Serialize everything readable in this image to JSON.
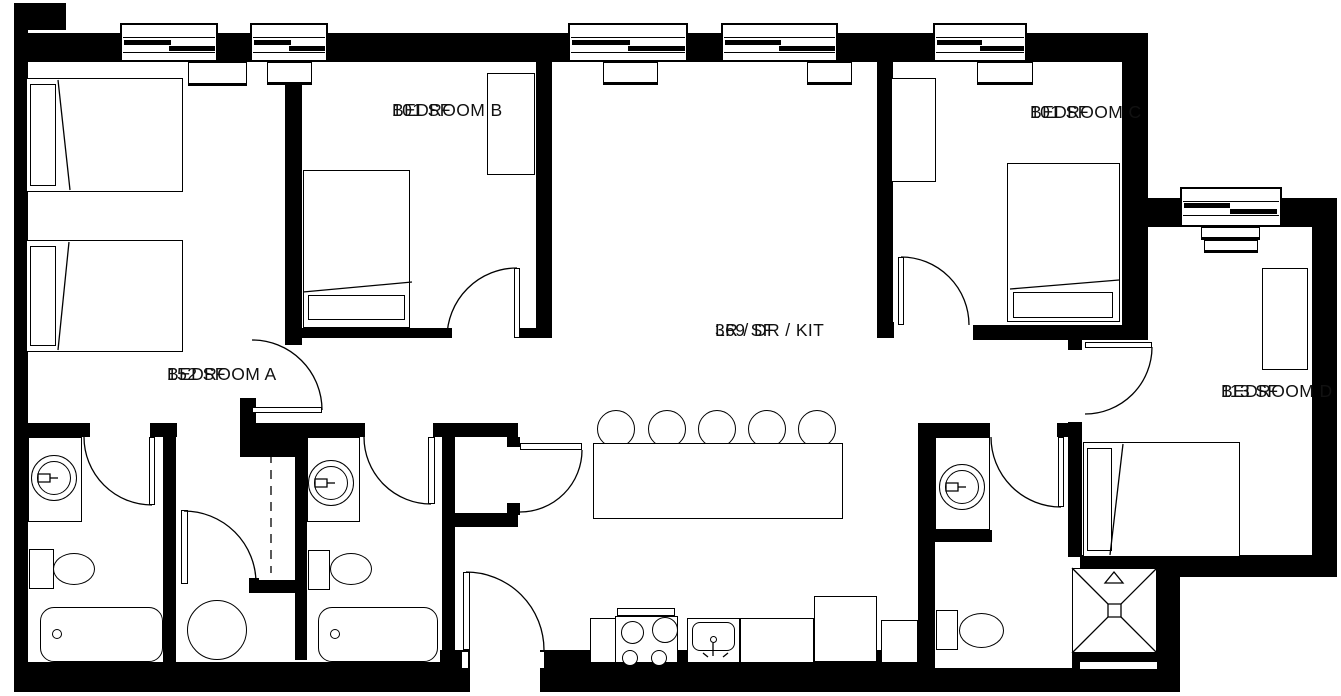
{
  "plan": {
    "title": "4-bedroom unit floor plan",
    "w": 1341,
    "h": 696,
    "ink": "#000000",
    "paper": "#ffffff",
    "rooms": [
      {
        "id": "bedroom-a",
        "name": "BEDROOM A",
        "area": "152 SF",
        "x": 167,
        "y": 362
      },
      {
        "id": "bedroom-b",
        "name": "BEDROOM B",
        "area": "101 SF",
        "x": 392,
        "y": 98
      },
      {
        "id": "bedroom-c",
        "name": "BEDROOM C",
        "area": "101 SF",
        "x": 1030,
        "y": 100
      },
      {
        "id": "living-dining-kitchen",
        "name": "LR / DR / KIT",
        "area": "369 SF",
        "x": 715,
        "y": 318
      },
      {
        "id": "bedroom-d",
        "name": "BEDROOM D",
        "area": "113 SF",
        "x": 1221,
        "y": 379
      }
    ],
    "walls": [
      [
        14,
        3,
        52,
        27
      ],
      [
        14,
        29,
        14,
        663
      ],
      [
        25,
        33,
        1115,
        29
      ],
      [
        285,
        62,
        17,
        283
      ],
      [
        536,
        62,
        16,
        276
      ],
      [
        877,
        62,
        16,
        276
      ],
      [
        1122,
        33,
        26,
        292
      ],
      [
        1148,
        198,
        32,
        29
      ],
      [
        1282,
        198,
        55,
        29
      ],
      [
        1312,
        227,
        25,
        350
      ],
      [
        302,
        328,
        150,
        10
      ],
      [
        517,
        328,
        20,
        10
      ],
      [
        877,
        322,
        17,
        16
      ],
      [
        973,
        325,
        175,
        15
      ],
      [
        1068,
        337,
        14,
        13
      ],
      [
        1068,
        422,
        14,
        135
      ],
      [
        1080,
        555,
        257,
        22
      ],
      [
        1157,
        577,
        23,
        113
      ],
      [
        920,
        668,
        260,
        24
      ],
      [
        1072,
        653,
        85,
        15
      ],
      [
        14,
        662,
        446,
        30
      ],
      [
        440,
        650,
        30,
        42
      ],
      [
        540,
        650,
        395,
        42
      ],
      [
        918,
        423,
        17,
        267
      ],
      [
        918,
        423,
        72,
        14
      ],
      [
        1057,
        423,
        11,
        14
      ],
      [
        933,
        530,
        59,
        12
      ],
      [
        14,
        423,
        76,
        14
      ],
      [
        150,
        423,
        27,
        14
      ],
      [
        163,
        437,
        13,
        230
      ],
      [
        240,
        398,
        16,
        27
      ],
      [
        240,
        423,
        57,
        34
      ],
      [
        249,
        578,
        10,
        15
      ],
      [
        258,
        580,
        40,
        13
      ],
      [
        295,
        423,
        12,
        237
      ],
      [
        300,
        423,
        65,
        14
      ],
      [
        433,
        423,
        85,
        14
      ],
      [
        442,
        437,
        13,
        213
      ],
      [
        452,
        513,
        66,
        14
      ],
      [
        507,
        437,
        13,
        10
      ],
      [
        507,
        503,
        13,
        12
      ]
    ],
    "notches": [
      [
        462,
        652,
        6,
        16
      ],
      [
        538,
        652,
        6,
        16
      ],
      [
        1080,
        662,
        77,
        7
      ]
    ],
    "windows": [
      {
        "frame": [
          120,
          23,
          98,
          39
        ],
        "bars": [
          [
            124,
            40,
            47,
            5
          ],
          [
            169,
            46,
            46,
            5
          ]
        ],
        "lines": [
          [
            123,
            37,
            92,
            1
          ],
          [
            123,
            52,
            92,
            1
          ]
        ]
      },
      {
        "frame": [
          250,
          23,
          78,
          39
        ],
        "bars": [
          [
            254,
            40,
            37,
            5
          ],
          [
            289,
            46,
            36,
            5
          ]
        ],
        "lines": [
          [
            253,
            37,
            72,
            1
          ],
          [
            253,
            52,
            72,
            1
          ]
        ]
      },
      {
        "frame": [
          568,
          23,
          120,
          39
        ],
        "bars": [
          [
            572,
            40,
            58,
            5
          ],
          [
            628,
            46,
            57,
            5
          ]
        ],
        "lines": [
          [
            571,
            37,
            114,
            1
          ],
          [
            571,
            52,
            114,
            1
          ]
        ]
      },
      {
        "frame": [
          721,
          23,
          117,
          39
        ],
        "bars": [
          [
            725,
            40,
            56,
            5
          ],
          [
            779,
            46,
            56,
            5
          ]
        ],
        "lines": [
          [
            724,
            37,
            111,
            1
          ],
          [
            724,
            52,
            111,
            1
          ]
        ]
      },
      {
        "frame": [
          933,
          23,
          94,
          39
        ],
        "bars": [
          [
            937,
            40,
            45,
            5
          ],
          [
            980,
            46,
            44,
            5
          ]
        ],
        "lines": [
          [
            936,
            37,
            88,
            1
          ],
          [
            936,
            52,
            88,
            1
          ]
        ]
      },
      {
        "frame": [
          1180,
          187,
          102,
          40
        ],
        "bars": [
          [
            1184,
            203,
            46,
            5
          ],
          [
            1230,
            209,
            47,
            5
          ]
        ],
        "lines": [
          [
            1183,
            201,
            96,
            1
          ],
          [
            1183,
            215,
            96,
            1
          ]
        ]
      }
    ],
    "sills": [
      [
        188,
        62,
        59,
        24
      ],
      [
        267,
        62,
        45,
        23
      ],
      [
        603,
        62,
        55,
        23
      ],
      [
        807,
        62,
        45,
        23
      ],
      [
        977,
        62,
        56,
        23
      ],
      [
        1201,
        227,
        59,
        13
      ],
      [
        1204,
        240,
        54,
        13
      ]
    ],
    "furniture": [
      [
        26,
        78,
        157,
        114,
        "box",
        "bed"
      ],
      [
        30,
        84,
        26,
        102,
        "box",
        "bed-headboard"
      ],
      [
        26,
        240,
        157,
        112,
        "box",
        "bed"
      ],
      [
        30,
        246,
        26,
        100,
        "box",
        "bed-headboard"
      ],
      [
        303,
        170,
        107,
        158,
        "box",
        "bed"
      ],
      [
        308,
        295,
        97,
        25,
        "box",
        "bed-pillow"
      ],
      [
        1007,
        163,
        113,
        159,
        "box",
        "bed"
      ],
      [
        1013,
        292,
        100,
        26,
        "box",
        "bed-pillow"
      ],
      [
        1083,
        442,
        157,
        115,
        "box",
        "bed"
      ],
      [
        1087,
        448,
        25,
        103,
        "box",
        "bed-pillow"
      ],
      [
        487,
        73,
        48,
        102,
        "box",
        "wardrobe"
      ],
      [
        891,
        78,
        45,
        104,
        "box",
        "wardrobe"
      ],
      [
        1262,
        268,
        46,
        102,
        "box",
        "wardrobe"
      ],
      [
        28,
        437,
        54,
        85,
        "box",
        "bathroom-vanity"
      ],
      [
        307,
        437,
        53,
        85,
        "box",
        "bathroom-vanity"
      ],
      [
        935,
        437,
        55,
        93,
        "box",
        "bathroom-vanity"
      ],
      [
        29,
        549,
        25,
        40,
        "box",
        "toilet-tank"
      ],
      [
        308,
        550,
        22,
        40,
        "box",
        "toilet-tank"
      ],
      [
        936,
        610,
        22,
        40,
        "box",
        "toilet-tank"
      ],
      [
        40,
        607,
        123,
        55,
        "tub",
        "bathtub"
      ],
      [
        318,
        607,
        120,
        55,
        "tub",
        "bathtub"
      ],
      [
        590,
        618,
        28,
        45,
        "box",
        "kitchen-counter"
      ],
      [
        617,
        608,
        58,
        8,
        "box",
        "stove-back-panel"
      ],
      [
        615,
        616,
        63,
        47,
        "box",
        "stove"
      ],
      [
        687,
        618,
        53,
        45,
        "box",
        "kitchen-sink"
      ],
      [
        692,
        622,
        43,
        29,
        "basin",
        "kitchen-sink-basin"
      ],
      [
        740,
        618,
        74,
        45,
        "box",
        "kitchen-counter"
      ],
      [
        814,
        596,
        63,
        66,
        "box",
        "refrigerator"
      ],
      [
        881,
        620,
        37,
        43,
        "box",
        "kitchen-counter"
      ],
      [
        1072,
        568,
        85,
        85,
        "box",
        "shower"
      ],
      [
        597,
        410,
        38,
        38,
        "round",
        "stool"
      ],
      [
        648,
        410,
        38,
        38,
        "round",
        "stool"
      ],
      [
        698,
        410,
        38,
        38,
        "round",
        "stool"
      ],
      [
        748,
        410,
        38,
        38,
        "round",
        "stool"
      ],
      [
        798,
        410,
        38,
        38,
        "round",
        "stool"
      ],
      [
        593,
        443,
        250,
        76,
        "box",
        "island-table"
      ],
      [
        187,
        600,
        60,
        60,
        "round",
        "washer"
      ],
      [
        53,
        553,
        42,
        32,
        "round",
        "toilet-bowl"
      ],
      [
        330,
        553,
        42,
        32,
        "round",
        "toilet-bowl"
      ],
      [
        959,
        613,
        45,
        35,
        "round",
        "toilet-bowl"
      ],
      [
        31,
        455,
        46,
        46,
        "round",
        "sink"
      ],
      [
        37,
        461,
        34,
        34,
        "round",
        "sink-basin"
      ],
      [
        308,
        460,
        46,
        46,
        "round",
        "sink"
      ],
      [
        314,
        466,
        34,
        34,
        "round",
        "sink-basin"
      ],
      [
        939,
        464,
        46,
        46,
        "round",
        "sink"
      ],
      [
        945,
        470,
        34,
        34,
        "round",
        "sink-basin"
      ],
      [
        621,
        621,
        23,
        23,
        "round",
        "burner"
      ],
      [
        652,
        617,
        26,
        26,
        "round",
        "burner"
      ],
      [
        622,
        650,
        16,
        16,
        "round",
        "burner"
      ],
      [
        651,
        650,
        16,
        16,
        "round",
        "burner"
      ],
      [
        52,
        629,
        10,
        10,
        "round",
        "tub-faucet"
      ],
      [
        330,
        629,
        10,
        10,
        "round",
        "tub-faucet"
      ],
      [
        710,
        636,
        7,
        7,
        "round",
        "kitchen-faucet"
      ]
    ],
    "doors": [
      {
        "leaf": [
          149,
          437,
          6,
          68
        ],
        "arc": "M84,437 A68,68 0 0 0 152,505"
      },
      {
        "leaf": [
          181,
          510,
          7,
          74
        ],
        "arc": "M184,511 A72,72 0 0 1 256,583"
      },
      {
        "leaf": [
          252,
          407,
          70,
          6
        ],
        "arc": "M322,410 A70,70 0 0 0 252,340"
      },
      {
        "leaf": [
          514,
          268,
          6,
          70
        ],
        "arc": "M447,338 A70,70 0 0 1 517,268"
      },
      {
        "leaf": [
          428,
          437,
          7,
          67
        ],
        "arc": "M364,437 A67,67 0 0 0 431,504"
      },
      {
        "leaf": [
          520,
          443,
          62,
          7
        ],
        "arc": "M582,450 A62,62 0 0 1 520,512"
      },
      {
        "leaf": [
          463,
          572,
          7,
          78
        ],
        "arc": "M466,572 A78,78 0 0 1 544,650"
      },
      {
        "leaf": [
          898,
          257,
          6,
          68
        ],
        "arc": "M901,257 A68,68 0 0 1 969,325"
      },
      {
        "leaf": [
          1085,
          342,
          67,
          6
        ],
        "arc": "M1152,347 A67,67 0 0 1 1085,414"
      },
      {
        "leaf": [
          1058,
          437,
          6,
          70
        ],
        "arc": "M991,437 A70,70 0 0 0 1061,507"
      }
    ],
    "linework": {
      "solid": [
        "M58,80 L70,190",
        "M69,242 L58,350",
        "M303,292 L412,282",
        "M1010,289 L1119,280",
        "M1123,444 L1110,555",
        "M1072,568 L1157,653",
        "M1157,568 L1072,653",
        "M50,478h8",
        "M327,483h8",
        "M958,487h8",
        "M713,643v13",
        "M703,653l5,4",
        "M728,653l-5,4"
      ],
      "dashed": [
        "M271,438 V573"
      ],
      "filled": [
        "M1108,604h13v13h-13z",
        "M1105,583L1123,583L1114,572Z",
        "M38,474h12v8h-12z",
        "M315,479h12v8h-12z",
        "M946,483h12v8h-12z"
      ]
    }
  }
}
